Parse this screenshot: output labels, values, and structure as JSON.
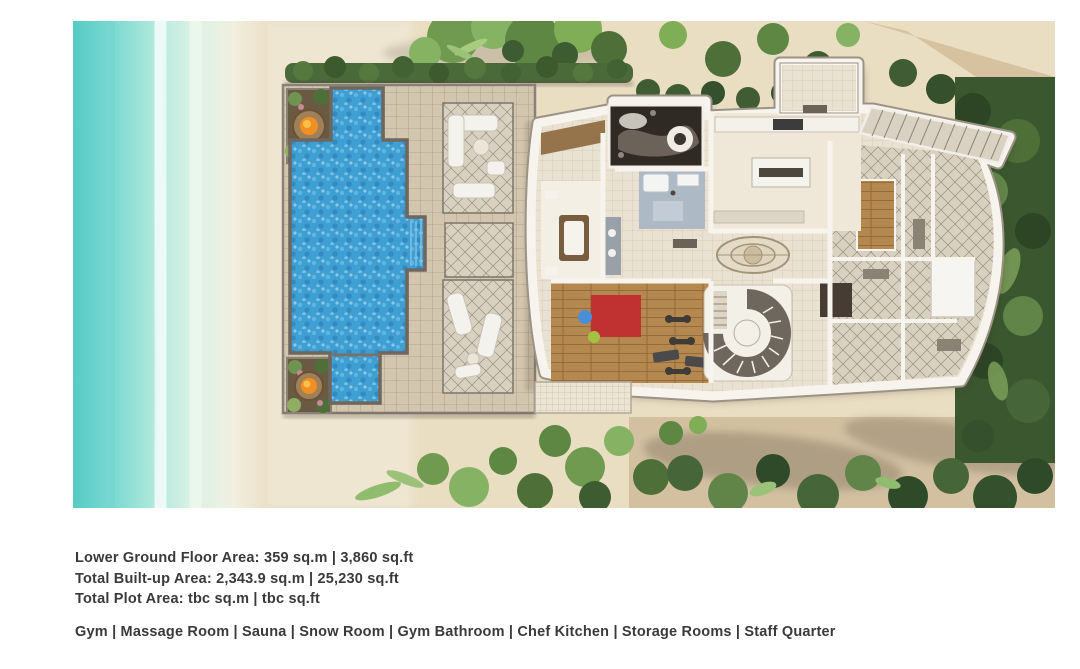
{
  "figure": {
    "name": "villa-lower-ground-floor-plan-rendering",
    "scene": {
      "ocean": "turquoise-sea-with-surf-foam",
      "beach": "white-sand-beach",
      "main_pool": "large-tiled-swimming-pool",
      "kids_pool": "small-square-pool",
      "fire_pits": "two-fire-pit-planters-with-flowers",
      "pool_deck": "tiled-deck-with-three-lounge-rugs-and-white-furniture",
      "building": "lower-ground-floor-with-gym-massage-room-sauna-snow-room-bathroom-chef-kitchen-storage-staff-quarter",
      "spiral_staircase": "curved-interior-staircase",
      "external_stairs": "diagonal-outdoor-staircase",
      "vegetation": "tropical-trees-and-hedges"
    },
    "colors": {
      "ocean": "#58cdc8",
      "foam": "#eef4ea",
      "sand": "#e9ddc2",
      "deck_tile": "#d3c6ae",
      "pool_water": "#3f9ed2",
      "greenery_light": "#7fae57",
      "greenery_dark": "#3d5c31",
      "building_wall": "#f7f4ed",
      "gym_floor": "#b5884f",
      "gym_mat": "#c03232",
      "fire": "#ef8f24",
      "text": "#3a3a3a"
    }
  },
  "details": {
    "lines": [
      "Lower Ground Floor Area: 359 sq.m | 3,860 sq.ft",
      "Total Built-up Area: 2,343.9 sq.m | 25,230 sq.ft",
      "Total Plot Area: tbc sq.m | tbc sq.ft"
    ],
    "amenities": "Gym | Massage Room | Sauna | Snow Room | Gym Bathroom | Chef Kitchen | Storage Rooms | Staff Quarter"
  }
}
